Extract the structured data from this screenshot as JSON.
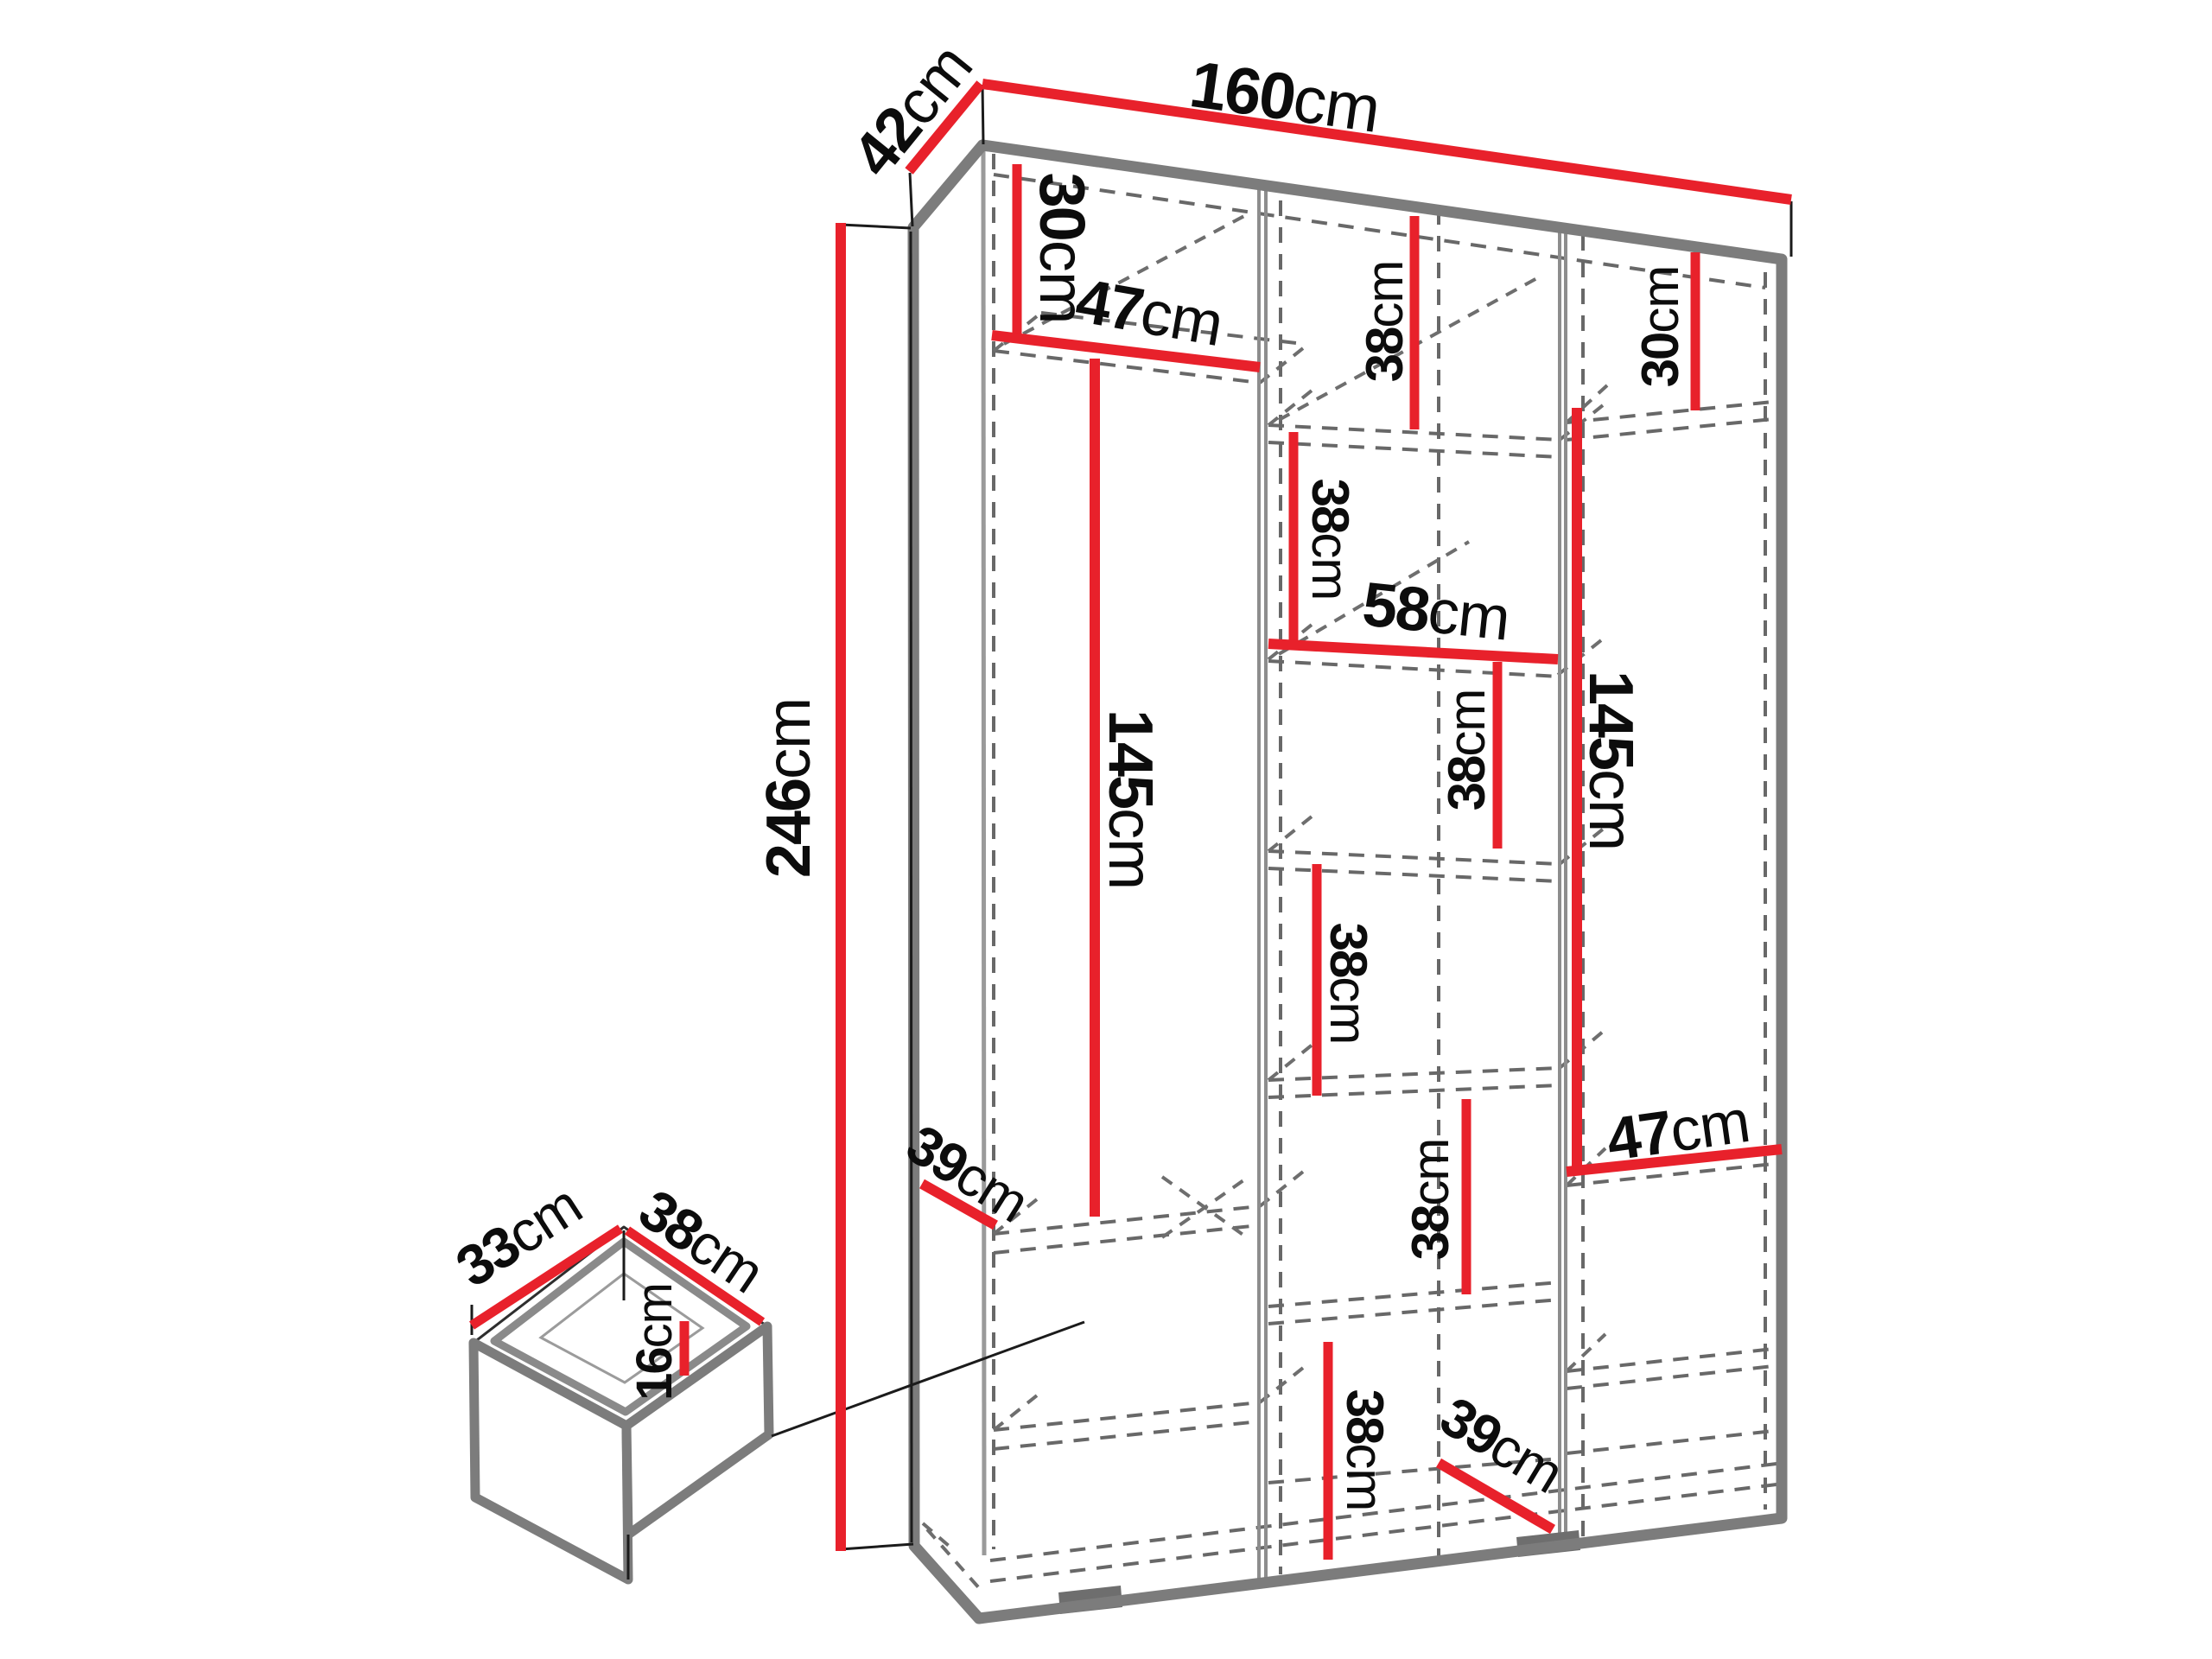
{
  "diagram": {
    "kind": "wardrobe-dimension-drawing",
    "unit": "cm",
    "accent_color": "#e8212b",
    "outline_color": "#7c7c7c",
    "text_color": "#0c0c0c"
  },
  "labels": {
    "width": {
      "value": "160",
      "unit": "cm"
    },
    "depth": {
      "value": "42",
      "unit": "cm"
    },
    "height": {
      "value": "246",
      "unit": "cm"
    },
    "left_top": {
      "value": "30",
      "unit": "cm"
    },
    "left_shelf": {
      "value": "47",
      "unit": "cm"
    },
    "left_hang": {
      "value": "145",
      "unit": "cm"
    },
    "left_depth": {
      "value": "39",
      "unit": "cm"
    },
    "mid_s1": {
      "value": "38",
      "unit": "cm"
    },
    "mid_s2": {
      "value": "38",
      "unit": "cm"
    },
    "mid_shelf": {
      "value": "58",
      "unit": "cm"
    },
    "mid_s3": {
      "value": "38",
      "unit": "cm"
    },
    "mid_s4": {
      "value": "38",
      "unit": "cm"
    },
    "mid_s5": {
      "value": "38",
      "unit": "cm"
    },
    "mid_s6": {
      "value": "38",
      "unit": "cm"
    },
    "mid_depth": {
      "value": "39",
      "unit": "cm"
    },
    "right_top": {
      "value": "30",
      "unit": "cm"
    },
    "right_hang": {
      "value": "145",
      "unit": "cm"
    },
    "right_shelf": {
      "value": "47",
      "unit": "cm"
    },
    "drawer_width": {
      "value": "33",
      "unit": "cm"
    },
    "drawer_depth": {
      "value": "38",
      "unit": "cm"
    },
    "drawer_height": {
      "value": "16",
      "unit": "cm"
    }
  }
}
